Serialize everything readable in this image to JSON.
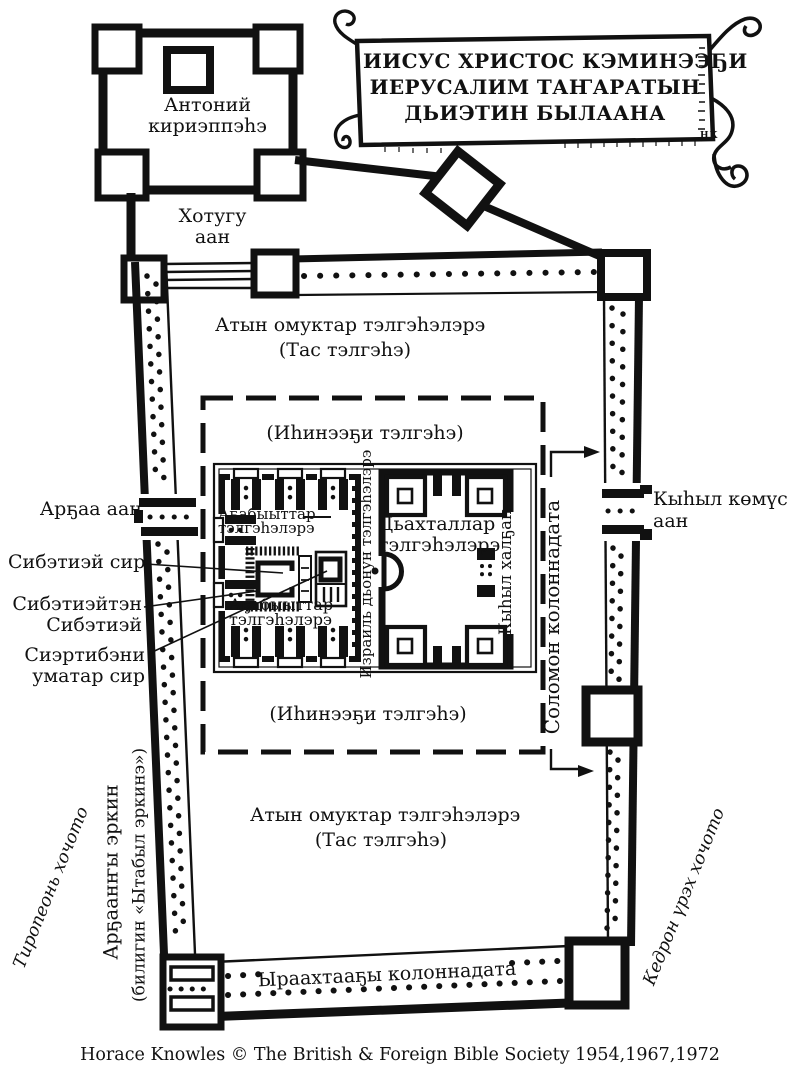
{
  "colors": {
    "ink": "#111111",
    "paper": "#ffffff"
  },
  "banner": {
    "line1": "ИИСУС ХРИСТОС КЭМИНЭЭҔИ",
    "line2": "ИЕРУСАЛИМ ТАҤАРАТЫН",
    "line3": "ДЬИЭТИН БЫЛААНА",
    "signature": "НК"
  },
  "fortress": {
    "line1": "Антоний",
    "line2": "кириэппэһэ"
  },
  "gates": {
    "north_l1": "Хотугу",
    "north_l2": "аан",
    "west": "Арҕаа аан",
    "golden_l1": "Кыһыл көмүс",
    "golden_l2": "аан",
    "beautiful": "Кыһыл халҕан"
  },
  "courts": {
    "outer_l1": "Атын омуктар тэлгэһэлэрэ",
    "outer_l2": "(Тас тэлгэһэ)",
    "inner": "(Иһинээҕи тэлгэһэ)",
    "priests_l1": "Аҕабыыттар",
    "priests_l2": "тэлгэһэлэрэ",
    "israel": "Израиль дьонун тэлгэһэлэрэ",
    "women_l1": "Дьахталлар",
    "women_l2": "тэлгэһэлэрэ"
  },
  "temple": {
    "holy_place": "Сибэтиэй сир",
    "holy_of_holies_l1": "Сибэтиэйтэн",
    "holy_of_holies_l2": "Сибэтиэй",
    "altar_l1": "Сиэртибэни",
    "altar_l2": "уматар сир"
  },
  "colonnades": {
    "solomon": "Соломон колоннадата",
    "royal": "Ыраахтааҕы колоннадата"
  },
  "surroundings": {
    "west_wall_l1": "Арҕаанҥы эркин",
    "west_wall_l2": "(билигин «Ытабыл эркинэ»)",
    "tyropoeon": "Тиропеонь хочото",
    "kidron": "Кедрон үрэх хочото"
  },
  "footer": {
    "copyright": "Horace Knowles © The British & Foreign Bible Society 1954,1967,1972"
  }
}
